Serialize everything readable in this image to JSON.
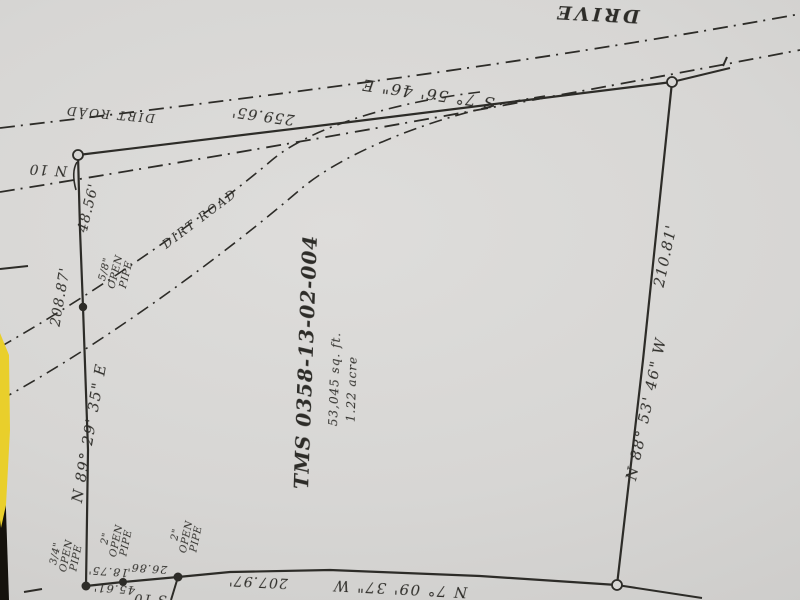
{
  "street": {
    "name": "DRIVE"
  },
  "roads": {
    "top_label": "DIRT ROAD",
    "diagonal_label": "DIRT ROAD"
  },
  "parcel": {
    "tms_label": "TMS 0358-13-02-004",
    "area_sqft": "53,045 sq. ft.",
    "area_acre": "1.22 acre"
  },
  "bearings": {
    "north": "S 7° 56' 46\" E",
    "west": "N 89° 29' 35\" E",
    "east": "N 88° 53' 46\" W",
    "south": "N 7° 09' 37\" W",
    "nw_partial": "N 10",
    "sw_partial": "S 10"
  },
  "distances": {
    "north": "259.65'",
    "west_upper": "48.56'",
    "west": "208.87'",
    "east": "210.81'",
    "south": "207.97'",
    "tie_1": "18.75'",
    "tie_2": "26.86'",
    "tie_total": "45.61'"
  },
  "monuments": {
    "pipe_5_8": "5/8\"\nOPEN\nPIPE",
    "pipe_3_4": "3/4\"\nOPEN\nPIPE",
    "pipe_2_a": "2\"\nOPEN\nPIPE",
    "pipe_2_b": "2\"\nOPEN\nPIPE"
  },
  "colors": {
    "ink": "#2d2c28",
    "paper": "#d7d6d4",
    "highlight_yellow": "#e9cf2b",
    "scanner_black": "#15120d"
  }
}
